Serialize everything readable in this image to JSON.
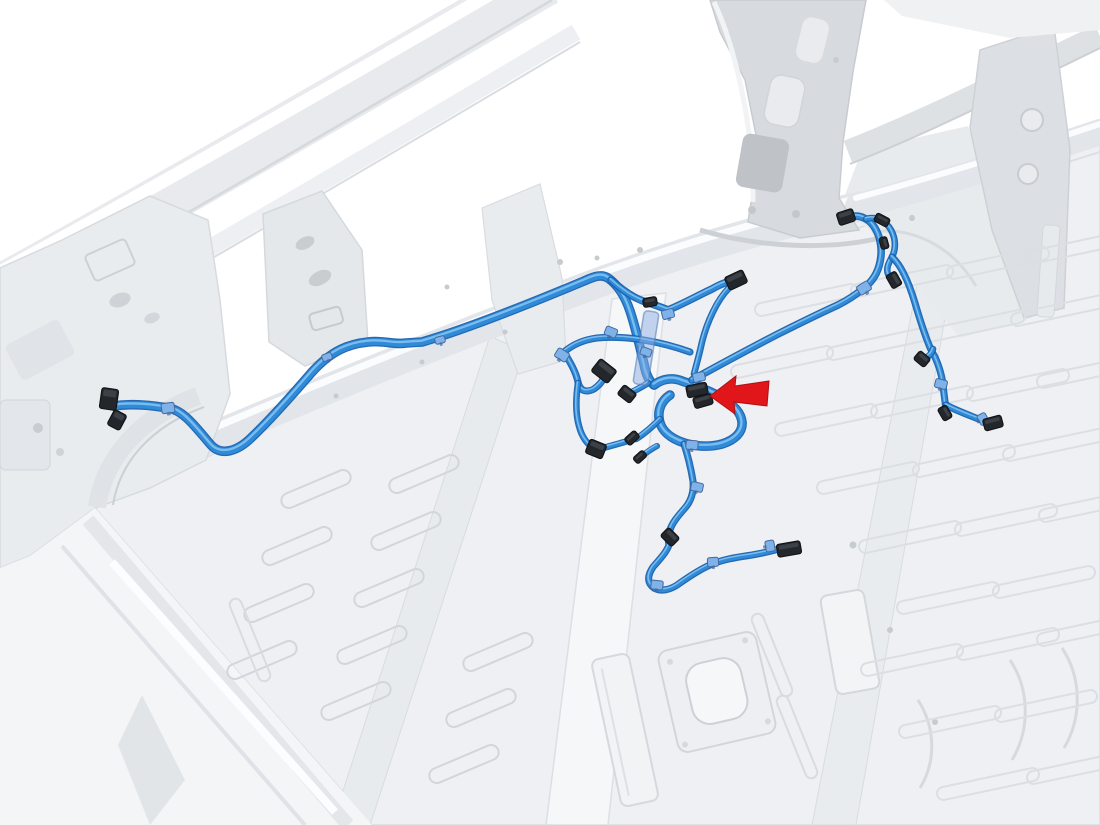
{
  "canvas": {
    "width": 1100,
    "height": 825
  },
  "illustration": {
    "kind": "vehicle-body-wiring-harness-location-diagram",
    "colors": {
      "background": "#ffffff",
      "wire_outline": "#1a61ad",
      "wire": "#2f8ad8",
      "wire_highlight": "#86c4f2",
      "clip_fill": "#7fb2e8",
      "clip_stroke": "#44699f",
      "connector_fill": "#23262a",
      "connector_stroke": "#0f1113",
      "connector_shine": "#41464d",
      "bracket_fill": "rgba(139,174,226,0.5)",
      "bracket_stroke": "rgba(80,120,180,0.55)"
    },
    "harness": {
      "paths": [
        {
          "id": "main-trunk",
          "w": 7,
          "d": "M 114 406 C 135 403 155 406 168 408 C 184 410 197 429 211 445 C 221 456 237 452 252 437 C 272 418 293 394 312 372 C 332 350 349 344 368 342 C 384 340 393 345 406 343 L 422 342 C 470 328 541 299 584 281 C 595 276 602 274 608 278 C 618 285 625 296 630 311 C 636 329 640 348 644 364 C 646 375 649 381 654 385"
        },
        {
          "id": "top-spur",
          "w": 5,
          "d": "M 611 280 C 621 289 632 297 643 301 C 652 304 661 307 668 310 C 681 305 699 295 712 289 C 721 284 728 281 735 281"
        },
        {
          "id": "top-connector-tail",
          "w": 4,
          "d": "M 729 288 C 717 300 707 322 702 342 C 699 356 696 366 694 374"
        },
        {
          "id": "center-loop",
          "w": 7,
          "d": "M 654 385 C 662 379 672 377 682 381 C 696 386 711 391 722 398 C 734 405 741 413 742 422 C 743 432 735 440 722 444 C 707 448 691 446 679 441 C 667 436 660 428 659 418 C 658 409 662 400 670 395"
        },
        {
          "id": "left-link",
          "w": 4.5,
          "d": "M 690 352 C 662 342 627 335 597 338 C 582 340 571 346 564 352 C 570 362 576 372 578 382 C 580 391 586 393 594 389 C 601 384 605 378 604 372"
        },
        {
          "id": "left-drop",
          "w": 4,
          "d": "M 578 383 C 576 397 575 412 579 426 C 582 438 588 445 595 449"
        },
        {
          "id": "c4-stub",
          "w": 4,
          "d": "M 648 383 C 642 387 636 390 630 393"
        },
        {
          "id": "cross-1",
          "w": 4,
          "d": "M 660 419 C 651 428 644 434 636 439"
        },
        {
          "id": "cross-2",
          "w": 3.5,
          "d": "M 657 446 C 651 449 646 453 642 456"
        },
        {
          "id": "cross-3",
          "w": 4,
          "d": "M 634 439 C 622 443 610 446 600 449"
        },
        {
          "id": "lower-branch",
          "w": 4.5,
          "d": "M 684 444 C 688 456 691 469 693 481 C 694 492 691 501 685 508 C 678 516 672 523 670 530 C 668 536 668 541 669 545 C 666 553 659 560 653 567 C 647 576 647 583 654 588 C 661 592 671 590 680 583 C 690 576 701 569 710 565 C 723 559 739 557 752 555 C 763 553 772 551 779 549"
        },
        {
          "id": "right-link",
          "w": 5,
          "d": "M 692 380 C 712 369 745 351 778 334 C 806 320 827 310 838 305 C 850 299 858 293 864 288 C 873 281 878 272 880 262 C 882 253 881 244 879 237 C 876 228 871 221 864 218 C 858 215 852 216 847 218"
        },
        {
          "id": "right-loop",
          "w": 4,
          "d": "M 866 219 C 876 216 886 221 891 230 C 896 239 896 249 892 257 C 888 264 886 269 888 274 C 889 277 891 279 893 281"
        },
        {
          "id": "right-drop",
          "w": 4.5,
          "d": "M 892 257 C 901 265 909 283 915 303 C 920 320 925 335 929 345 C 931 350 933 354 935 357 C 939 366 942 376 943 385 C 944 394 945 402 946 408"
        },
        {
          "id": "right-hook",
          "w": 4,
          "d": "M 933 349 C 932 354 928 357 924 359"
        },
        {
          "id": "right-end",
          "w": 4.5,
          "d": "M 946 405 C 953 409 966 414 976 418 C 983 421 987 422 991 423"
        }
      ],
      "connectors": [
        {
          "id": "left-end-a",
          "x": 109,
          "y": 399,
          "w": 17,
          "h": 21,
          "r": 8
        },
        {
          "id": "left-end-b",
          "x": 117,
          "y": 420,
          "w": 14,
          "h": 17,
          "r": 28
        },
        {
          "id": "top-right",
          "x": 736,
          "y": 280,
          "w": 20,
          "h": 14,
          "r": -25
        },
        {
          "id": "inline-top",
          "x": 650,
          "y": 302,
          "w": 14,
          "h": 9,
          "r": -10
        },
        {
          "id": "mid-left-a",
          "x": 604,
          "y": 371,
          "w": 21,
          "h": 16,
          "r": 38
        },
        {
          "id": "mid-left-b",
          "x": 627,
          "y": 394,
          "w": 16,
          "h": 12,
          "r": 38
        },
        {
          "id": "arrow-target-a",
          "x": 697,
          "y": 390,
          "w": 21,
          "h": 12,
          "r": -12
        },
        {
          "id": "arrow-target-b",
          "x": 703,
          "y": 401,
          "w": 19,
          "h": 11,
          "r": -16
        },
        {
          "id": "lower-left",
          "x": 596,
          "y": 449,
          "w": 18,
          "h": 15,
          "r": 22
        },
        {
          "id": "lower-mid-a",
          "x": 632,
          "y": 438,
          "w": 14,
          "h": 9,
          "r": -42
        },
        {
          "id": "lower-mid-b",
          "x": 640,
          "y": 457,
          "w": 13,
          "h": 8,
          "r": -42
        },
        {
          "id": "inline-lower",
          "x": 670,
          "y": 537,
          "w": 16,
          "h": 12,
          "r": 45
        },
        {
          "id": "lower-right",
          "x": 789,
          "y": 549,
          "w": 24,
          "h": 13,
          "r": -10
        },
        {
          "id": "top-right-branch-end",
          "x": 846,
          "y": 217,
          "w": 17,
          "h": 13,
          "r": -18
        },
        {
          "id": "branch-black-clip-a",
          "x": 882,
          "y": 220,
          "w": 15,
          "h": 9,
          "r": 28
        },
        {
          "id": "branch-black-clip-b",
          "x": 884,
          "y": 243,
          "w": 12,
          "h": 8,
          "r": 75
        },
        {
          "id": "branch-stub",
          "x": 894,
          "y": 280,
          "w": 15,
          "h": 11,
          "r": 60
        },
        {
          "id": "right-hook-end",
          "x": 922,
          "y": 359,
          "w": 14,
          "h": 11,
          "r": 40
        },
        {
          "id": "right-stub",
          "x": 945,
          "y": 413,
          "w": 14,
          "h": 10,
          "r": 60
        },
        {
          "id": "right-branch-end",
          "x": 993,
          "y": 423,
          "w": 19,
          "h": 12,
          "r": -15
        }
      ],
      "clips": [
        {
          "x": 168,
          "y": 408,
          "w": 13,
          "h": 10,
          "r": -8
        },
        {
          "x": 327,
          "y": 357,
          "w": 10,
          "h": 7,
          "r": -20
        },
        {
          "x": 440,
          "y": 340,
          "w": 10,
          "h": 7,
          "r": -15
        },
        {
          "x": 562,
          "y": 355,
          "w": 13,
          "h": 10,
          "r": 32
        },
        {
          "x": 611,
          "y": 332,
          "w": 12,
          "h": 9,
          "r": 22
        },
        {
          "x": 668,
          "y": 314,
          "w": 12,
          "h": 9,
          "r": -15
        },
        {
          "x": 646,
          "y": 352,
          "w": 11,
          "h": 8,
          "r": 20
        },
        {
          "x": 699,
          "y": 377,
          "w": 12,
          "h": 9,
          "r": -12
        },
        {
          "x": 692,
          "y": 445,
          "w": 12,
          "h": 9,
          "r": 4
        },
        {
          "x": 697,
          "y": 487,
          "w": 12,
          "h": 9,
          "r": 12
        },
        {
          "x": 657,
          "y": 585,
          "w": 12,
          "h": 9,
          "r": 6
        },
        {
          "x": 713,
          "y": 562,
          "w": 11,
          "h": 9,
          "r": -4
        },
        {
          "x": 770,
          "y": 546,
          "w": 11,
          "h": 9,
          "r": 80
        },
        {
          "x": 864,
          "y": 288,
          "w": 13,
          "h": 10,
          "r": -32
        },
        {
          "x": 941,
          "y": 384,
          "w": 12,
          "h": 9,
          "r": 14
        },
        {
          "x": 983,
          "y": 419,
          "w": 11,
          "h": 9,
          "r": 62
        }
      ],
      "bracket": {
        "x": 646,
        "y": 348,
        "w": 15,
        "h": 74,
        "rot": 9
      }
    },
    "callout_arrow": {
      "points": "710,396 736,376 735,386 769,381 767,406 734,402 735,414",
      "fill": "#e1161b",
      "stroke": "#b01013"
    }
  }
}
